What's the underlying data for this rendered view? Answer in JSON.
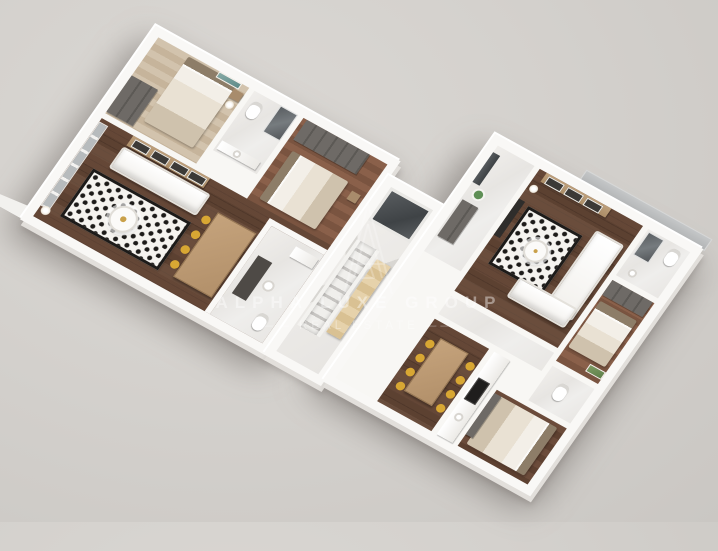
{
  "watermark": {
    "brand": "ALPHA LUXE GROUP",
    "tagline": "REAL ESTATE",
    "dash": "——",
    "logo": "alpha-triangle-monogram"
  },
  "palette": {
    "background": "#d4d1cd",
    "wall_white": "#f8f7f4",
    "wall_shade": "#e2dfdb",
    "floor_walnut": "#5e4232",
    "floor_oak_light": "#ccbba3",
    "floor_oak_medium": "#82593f",
    "marble": "#ebe9e6",
    "rug_base": "#f5f3ef",
    "rug_dot": "#1d1b19",
    "sofa_white": "#f4f2ee",
    "dining_chair_gold": "#d8a733",
    "dining_table_wood": "#bb976f",
    "wardrobe_gray": "#66625e",
    "glass_dark": "#4b5054",
    "accent_teal": "#6f9a97",
    "accent_green": "#5f8f56",
    "watermark_white": "rgba(255,255,255,0.4)"
  },
  "scene": {
    "type": "aerial 3d floor plan render",
    "building_rotation_deg": 29,
    "units": [
      {
        "id": "left-apartment",
        "rooms": [
          "bedroom-1",
          "bathroom-1",
          "bedroom-2",
          "living-dining-room",
          "bathroom-2"
        ]
      },
      {
        "id": "right-apartment",
        "rooms": [
          "entry-hall",
          "living-room",
          "bathroom-1",
          "bedroom-1",
          "corridor",
          "dining-kitchen",
          "bathroom-2",
          "bedroom-2"
        ]
      }
    ],
    "core": [
      "staircase",
      "elevator",
      "west-balcony-ledge",
      "northeast-glass-terrace"
    ]
  }
}
